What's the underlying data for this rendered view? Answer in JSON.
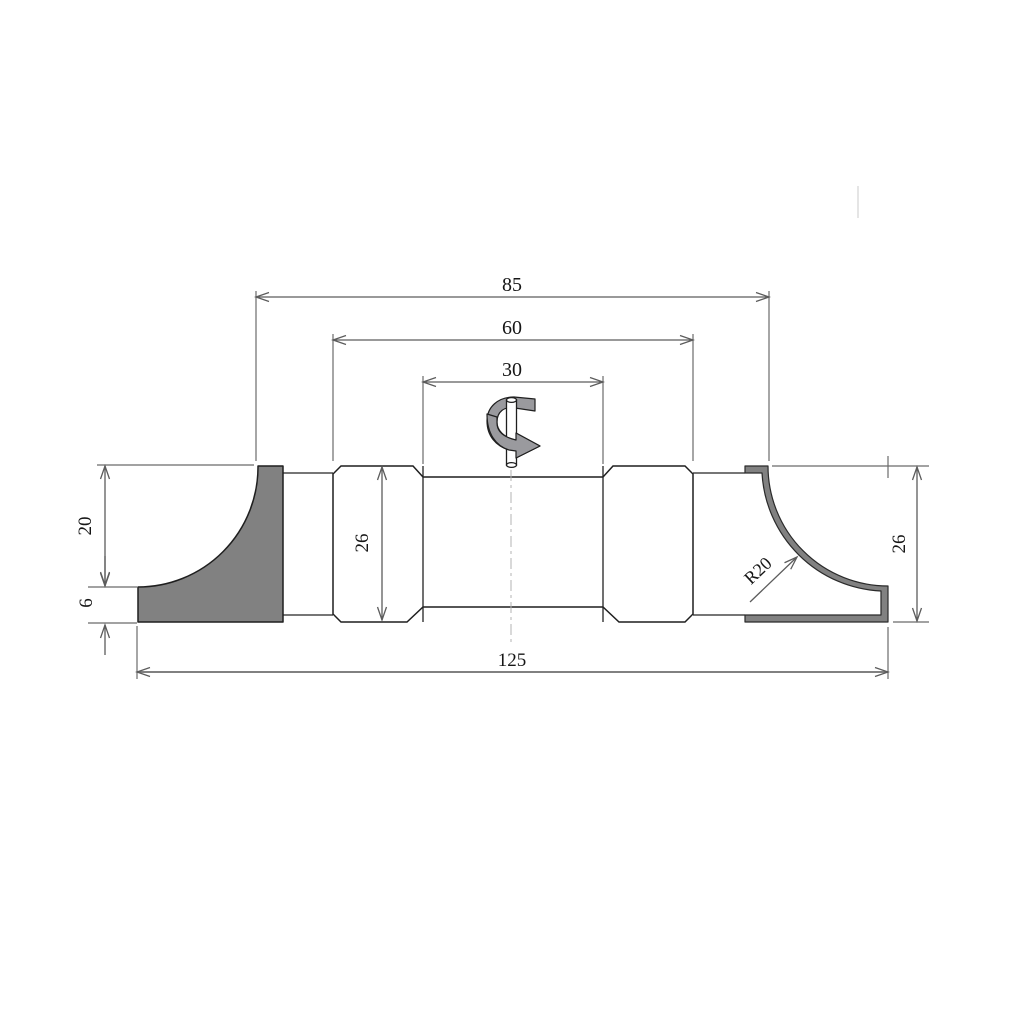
{
  "dims": {
    "d85": "85",
    "d60": "60",
    "d30": "30",
    "d26_left": "26",
    "d26_right": "26",
    "d20": "20",
    "d6": "6",
    "d125": "125",
    "r20": "R20"
  },
  "colors": {
    "object_line": "#1f1f1f",
    "dimension_line": "#5c5c5c",
    "knife_fill": "#818181",
    "rotation_arrow_fill": "#9a9a9e",
    "centerline": "#b3b3b3",
    "background": "#ffffff"
  }
}
